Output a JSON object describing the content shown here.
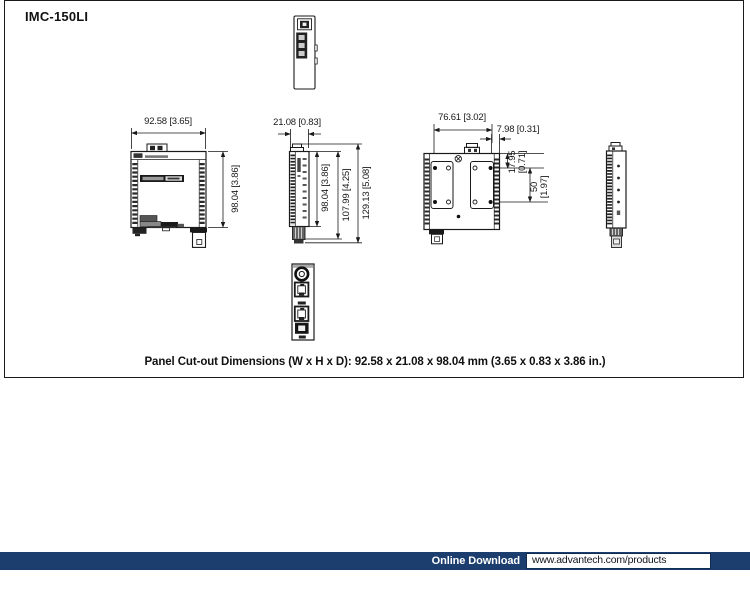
{
  "header": {
    "title": "IMC-150LI"
  },
  "caption": "Panel Cut-out Dimensions (W x H x D): 92.58 x 21.08 x 98.04 mm (3.65 x 0.83 x 3.86 in.)",
  "dimensions": {
    "front_width": "92.58 [3.65]",
    "front_height": "98.04 [3.86]",
    "side_width": "21.08 [0.83]",
    "side_body_height": "98.04 [3.86]",
    "side_mid_height": "107.99 [4.25]",
    "side_total_height": "129.13 [5.08]",
    "rear_hole_span": "76.61 [3.02]",
    "rear_edge_offset": "7.98 [0.31]",
    "rear_top_offset_mm": "17.95",
    "rear_top_offset_in": "[0.71]",
    "rear_hole_spacing_mm": "50",
    "rear_hole_spacing_in": "[1.97]"
  },
  "footer": {
    "label": "Online Download",
    "url": "www.advantech.com/products"
  },
  "colors": {
    "accent_navy": "#1c3e6e",
    "line": "#1a1a1a"
  }
}
